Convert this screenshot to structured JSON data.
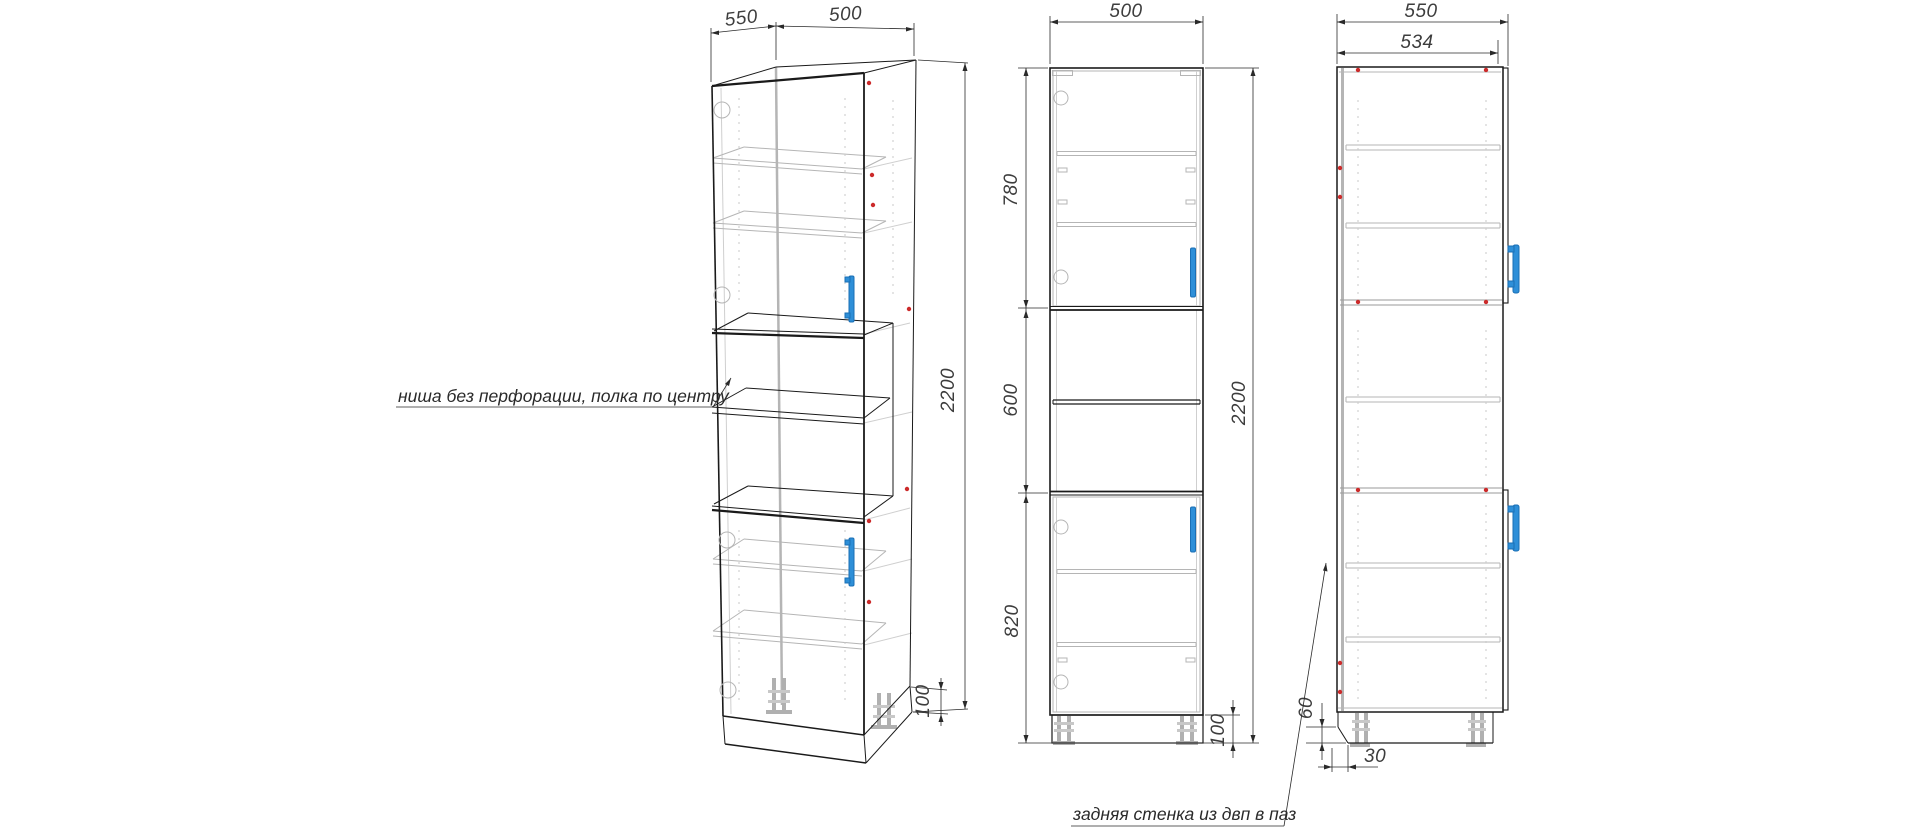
{
  "annotations": {
    "niche_note": "ниша без перфорации, полка по центру",
    "back_note": "задняя стенка из двп в паз"
  },
  "views": {
    "isometric": {
      "dim_depth": "550",
      "dim_width": "500",
      "dim_height": "2200",
      "dim_plinth": "100"
    },
    "front": {
      "dim_width": "500",
      "dim_upper": "780",
      "dim_middle": "600",
      "dim_lower": "820",
      "dim_height": "2200",
      "dim_plinth": "100"
    },
    "side": {
      "dim_depth": "550",
      "dim_inner_depth": "534",
      "dim_back_offset": "60",
      "dim_plinth_recess": "30"
    }
  },
  "colors": {
    "outline": "#1a1a1a",
    "interior": "#b5b5b5",
    "handle": "#2e8fd8",
    "screw": "#cc2a2a",
    "dim_text": "#3d3d3d"
  }
}
